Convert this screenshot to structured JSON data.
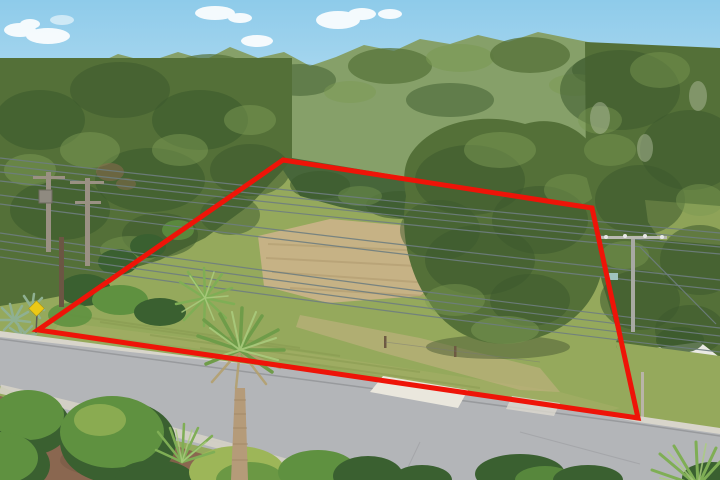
{
  "scene": {
    "description": "Aerial drone photograph of a vacant grassy residential lot outlined with a red property-boundary polygon, bordered by a curving street with palm trees and shrubs in the foreground, dense green tree canopy behind, overhead power lines and utility poles, blue sky with small clouds. No text visible in the photo.",
    "colors": {
      "sky_top": "#8ecbea",
      "sky_low": "#cfe9f6",
      "cloud": "#ffffff",
      "canopy_haze": "#86a069",
      "canopy_mid": "#547038",
      "canopy_dark": "#3c5a2d",
      "canopy_light": "#7b9a53",
      "grass": "#95a95c",
      "grass_worn": "#a7b068",
      "dirt": "#c6b285",
      "dirt_row": "#b19c70",
      "road": "#b3b5b8",
      "curb": "#d8d5cb",
      "apron": "#eae7dd",
      "sidewalk": "#d5d2c6",
      "mulch": "#8a6750",
      "bush": "#5f9140",
      "bush_dark": "#3a6030",
      "bush_light": "#9db658",
      "palm": "#7fae55",
      "palm_light": "#abcd7f",
      "palm_dead": "#b3a06f",
      "trunk": "#b59b79",
      "wire": "#6e7d7f",
      "pole": "#9a9183",
      "pole_brown": "#6b5643",
      "boundary": "#ee1408",
      "sign": "#ecc916",
      "structure": "#eae9e4",
      "agave": "#8fb092"
    },
    "boundary": {
      "points": "283,160 592,208 638,418 38,330",
      "stroke_width": 5
    },
    "treeline": {
      "top_path": "M0,78 L22,64 L45,72 L68,58 L92,66 L118,54 L148,62 L178,52 L205,60 L230,47 L258,58 L284,52 L310,66 L336,57 L364,45 L394,51 L420,39 L450,44 L478,35 L508,42 L538,32 L568,38 L598,44 L624,52 L650,47 L676,56 L700,51 L720,57 L720,178 L0,178 Z",
      "left_mass": "M0,58 L292,58 L292,160 L283,170 L250,205 L205,238 L160,260 L120,272 L82,292 L40,300 L0,306 Z",
      "center_band": "M283,170 L292,158 L592,208 L592,226 L540,230 L470,224 L400,218 L340,207 L300,196 Z",
      "big_oak": "M412,152 C435,120 485,112 525,124 C565,112 598,140 604,172 C622,200 618,248 600,278 C590,312 560,335 520,342 C480,350 445,330 428,300 C408,272 400,230 406,196 C402,175 405,162 412,152 Z",
      "right_mass": "M585,42 L720,48 L720,370 L688,366 L658,370 L636,356 L616,328 L602,282 L590,230 L596,212 L586,175 Z"
    },
    "lot": {
      "grass_points": "0,350 0,300 120,248 283,158 600,205 662,305 720,345 720,480 0,480",
      "worn_path_points": "60,322 300,352 560,392 620,408 600,414 300,362 55,330",
      "dirt_points": "258,236 330,219 432,228 463,262 420,296 328,303 264,286",
      "dirt_trail_points": "300,315 420,338 540,368 560,392 520,390 380,352 296,327",
      "right_gap_points": "645,200 720,206 720,245 660,240 648,222"
    },
    "street": {
      "road_points": "0,337 130,352 330,373 520,399 638,422 720,434 720,480 452,480 240,456 60,413 0,386",
      "curb_points": "0,331 638,416 720,428 720,435 638,423 0,339",
      "apron_points": "383,376 468,390 458,408 370,392",
      "apron2_points": "512,396 560,403 554,416 506,409",
      "verge_points": "615,342 720,356 720,430 640,419",
      "mulch_points": "0,396 150,438 280,478 310,480 0,480",
      "sidewalk_path": "M0,389 C100,412 200,438 310,470"
    },
    "wires": [
      "M0,158 Q360,200 720,233",
      "M0,165 Q360,207 720,240",
      "M0,172 Q360,214 720,247",
      "M0,181 Q360,222 720,254",
      "M0,195 Q360,242 720,280",
      "M0,204 Q360,251 720,290",
      "M0,233 Q360,286 720,328",
      "M0,241 Q360,294 720,336",
      "M0,249 Q360,302 720,344",
      "M0,257 Q360,310 720,352",
      "M640,247 L716,324"
    ],
    "palms": {
      "large_trunk_path": "M235,388 L231,480 L248,480 L245,388 Z"
    }
  }
}
